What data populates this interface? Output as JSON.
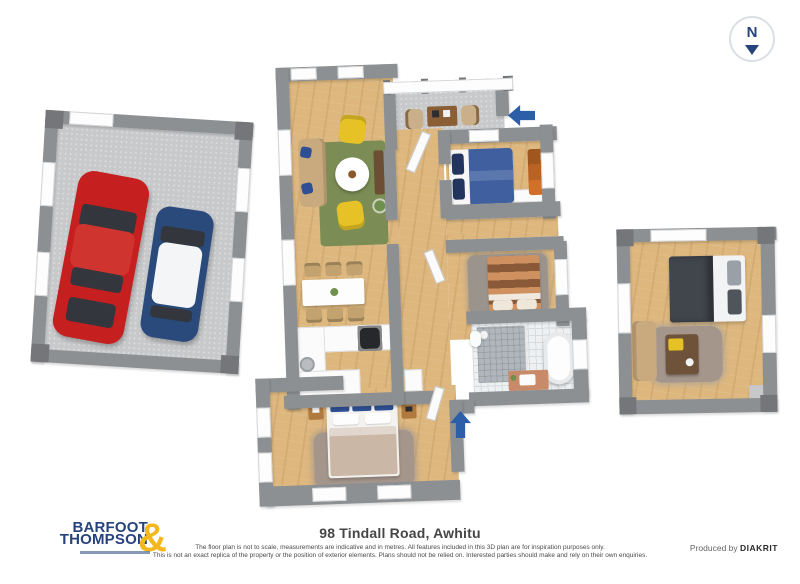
{
  "compass": {
    "label": "N"
  },
  "branding": {
    "logo_line1": "BARFOOT",
    "logo_line2": "THOMPSON",
    "logo_ampersand": "&"
  },
  "footer": {
    "address": "98 Tindall Road, Awhitu",
    "disclaimer_line1": "The floor plan is not to scale, measurements are indicative and in metres. All features included in this 3D plan are for inspiration purposes only.",
    "disclaimer_line2": "This is not an exact replica of the property or the position of exterior elements. Plans should not be relied on. Interested parties should make and rely on their own enquiries.",
    "produced_by_prefix": "Produced by",
    "produced_by_brand": "DIAKRIT"
  },
  "floorplan": {
    "view": "3d-top-down",
    "buildings": [
      {
        "id": "garage",
        "type": "double-garage",
        "contents": [
          "red-car",
          "blue-car"
        ]
      },
      {
        "id": "main-house",
        "rooms": [
          "entry-porch",
          "living-room",
          "dining-area",
          "kitchen",
          "hallway",
          "bedroom-1",
          "bedroom-2",
          "bathroom",
          "master-bedroom"
        ]
      },
      {
        "id": "sleepout",
        "rooms": [
          "bedroom-3-with-lounge"
        ]
      }
    ],
    "entry_arrow_count": 2
  },
  "colors": {
    "wall": "#8d9093",
    "wall_dark": "#74767a",
    "wood": "#ddb77e",
    "concrete": "#c8c9cb",
    "tile": "#eef0f2",
    "tile_line": "#d7dbde",
    "shower": "#b0b6bb",
    "rug_green": "#7b8d55",
    "rug_gray": "#9b948d",
    "rug_taupe": "#a5968c",
    "sofa_beige": "#c9a97e",
    "chair_yellow": "#e6c226",
    "chair_beige": "#c2a26f",
    "bed_blue": "#3f5f9e",
    "pillow_navy": "#23355f",
    "wardrobe_orange": "#d2702a",
    "bed_stripe_light": "#cf9160",
    "bed_stripe_dark": "#8a5a38",
    "bed_beige": "#cbb7a6",
    "pillow_blue": "#2e4f93",
    "bed_dark": "#41454c",
    "car_red": "#c5201f",
    "car_blue": "#2a4a7c",
    "arrow_blue": "#2d5fa8",
    "logo_navy": "#27437c",
    "logo_gold": "#f5b71e",
    "text_dark": "#454545",
    "text_gray": "#4a4a4a"
  }
}
